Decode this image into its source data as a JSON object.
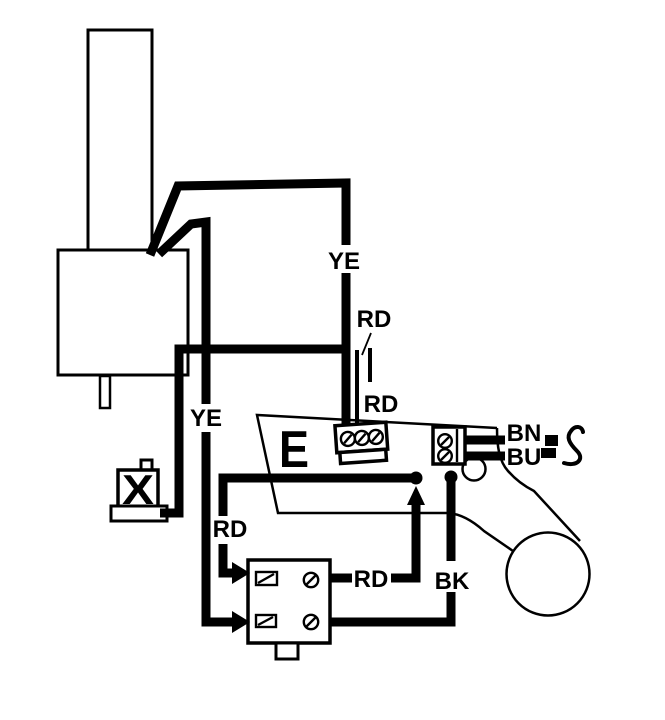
{
  "colors": {
    "ink": "#000000",
    "paper": "#ffffff"
  },
  "labels": {
    "ye_main_riser": "YE",
    "rd_callout": "RD",
    "rd_stub": "RD",
    "ye_left_drop": "YE",
    "rd_left_branch": "RD",
    "rd_jumper": "RD",
    "bk_wire": "BK",
    "bn_wire": "BN",
    "bu_wire": "BU",
    "earth_module": "E",
    "x_solenoid": "X"
  }
}
